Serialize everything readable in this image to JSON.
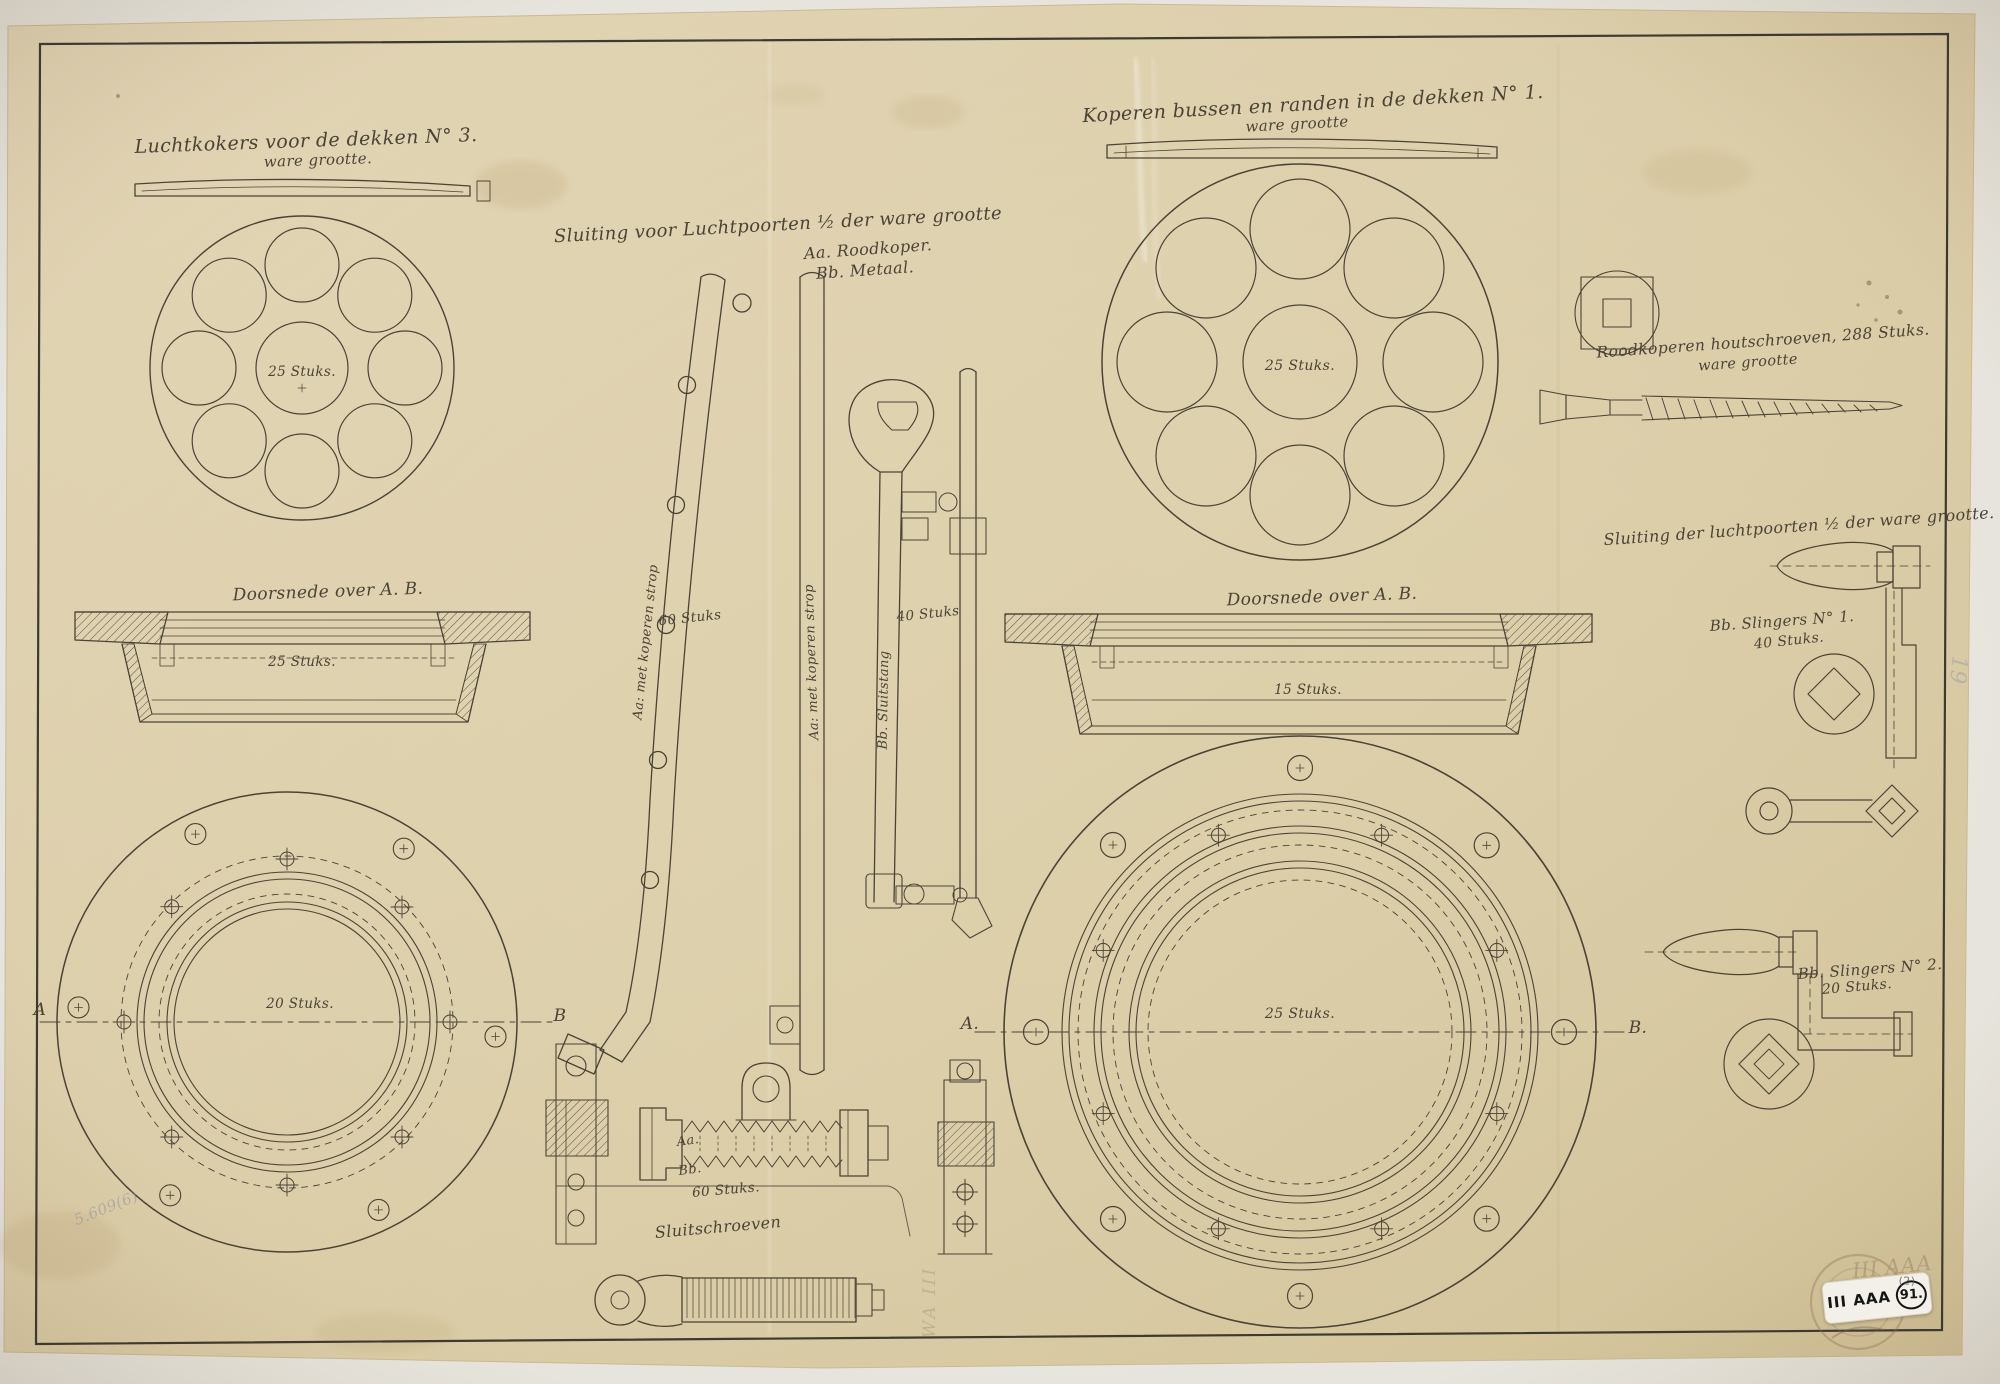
{
  "colors": {
    "paper": "#ddcfa9",
    "ink": "#4b4336",
    "sticker": "#f2f0e8",
    "pencil": "#8b8da0"
  },
  "titles": {
    "top_left_line1": "Luchtkokers voor de dekken N° 3.",
    "top_left_line2": "ware grootte.",
    "top_right_line1": "Koperen bussen en randen in de dekken N° 1.",
    "top_right_line2": "ware grootte",
    "center_line1": "Sluiting voor Luchtpoorten ½ der ware grootte",
    "center_material_a": "Aa. Roodkoper.",
    "center_material_b": "Bb. Metaal.",
    "screws_line1": "Roodkoperen houtschroeven, 288 Stuks.",
    "screws_line2": "ware grootte",
    "closures_title": "Sluiting der luchtpoorten ½ der ware grootte."
  },
  "sections": {
    "left_label": "Doorsnede over A. B.",
    "right_label": "Doorsnede over A. B."
  },
  "quantities": {
    "top_left_disc": "25 Stuks.",
    "left_section": "25 Stuks.",
    "left_flange": "20 Stuks.",
    "top_right_disc": "25 Stuks.",
    "right_section": "15 Stuks.",
    "right_flange": "25 Stuks.",
    "strap_bar": "60 Stuks",
    "lock_rod": "40 Stuks",
    "lock_screws": "60 Stuks."
  },
  "parts": {
    "strap_bar_note": "Aa: met koperen strop",
    "straight_bar_note": "Aa: met koperen strop",
    "lock_rod_name": "Bb. Sluitstang",
    "assembly_part_a": "Aa.",
    "assembly_part_b": "Bb.",
    "lock_screws_title": "Sluitschroeven",
    "crank1_line1": "Bb. Slingers N° 1.",
    "crank1_line2": "40 Stuks.",
    "crank2_line1": "Bb. Slingers N° 2.",
    "crank2_line2": "20 Stuks."
  },
  "markers": {
    "left_a": "A",
    "left_b": "B",
    "right_a": "A.",
    "right_b": "B."
  },
  "annotations": {
    "sticker_text": "III AAA",
    "sticker_number": "91.",
    "sticker_index": "(2)",
    "pencil_stamp": "III AAA",
    "pencil_bottom_left": "5.609(6)",
    "pencil_center": "WA III",
    "pencil_right_edge": "19"
  }
}
